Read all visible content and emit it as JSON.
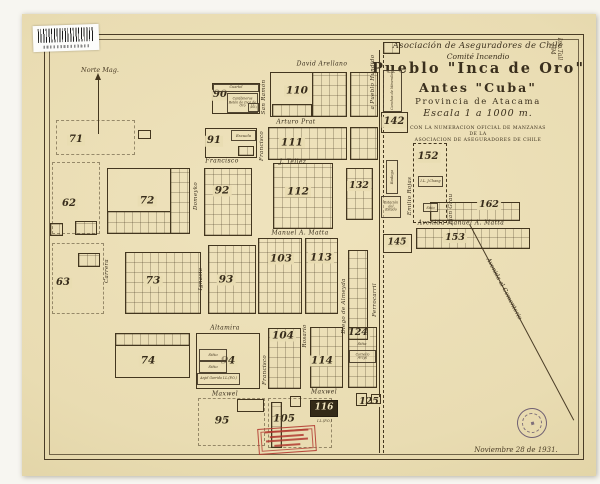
{
  "page": {
    "paper_color": "#e9dcb2",
    "ink_color": "#43361f",
    "stamp_red": "#b23a30",
    "stamp_purple": "#524264"
  },
  "title_block": {
    "org": "Asociación de Aseguradores de Chile",
    "committee": "Comité Incendio",
    "title1": "Pueblo \"Inca de Oro\"",
    "title2": "Antes \"Cuba\"",
    "province": "Provincia de Atacama",
    "scale": "Escala 1 a 1000 m.",
    "note1": "CON LA NUMERACION OFICIAL DE MANZANAS",
    "note2": "DE LA",
    "note3": "ASOCIACION DE ASEGURADORES DE CHILE"
  },
  "annotations": {
    "north": "Norte Mag.",
    "railroad_label": "Ferrocarril",
    "road_label": "a Pueblo Hundido",
    "cemetery_label": "Avenida al Cementerio",
    "date": "Noviembre 28 de 1931.",
    "corner_mark": "Inc.Tall\n194"
  },
  "map": {
    "streets_h": [
      {
        "name": "David Arellano",
        "x": 322,
        "y": 64
      },
      {
        "name": "Arturo Prat",
        "x": 296,
        "y": 122
      },
      {
        "name": "Francisco",
        "x": 222,
        "y": 161
      },
      {
        "name": "J. Tellez",
        "x": 293,
        "y": 162
      },
      {
        "name": "Manuel A. Matta",
        "x": 300,
        "y": 233
      },
      {
        "name": "Avenida Manuel A. Matta",
        "x": 461,
        "y": 223
      },
      {
        "name": "Altamira",
        "x": 225,
        "y": 328
      },
      {
        "name": "Maxwel",
        "x": 225,
        "y": 394
      },
      {
        "name": "Maxwel",
        "x": 324,
        "y": 392
      }
    ],
    "streets_v": [
      {
        "name": "San Ramón",
        "x": 264,
        "y": 97
      },
      {
        "name": "Francisco",
        "x": 262,
        "y": 146
      },
      {
        "name": "Domeyko",
        "x": 196,
        "y": 196
      },
      {
        "name": "Carrera",
        "x": 107,
        "y": 271
      },
      {
        "name": "Ignacio",
        "x": 201,
        "y": 279
      },
      {
        "name": "Francisco",
        "x": 265,
        "y": 370
      },
      {
        "name": "Rosario",
        "x": 305,
        "y": 336
      },
      {
        "name": "Diego de Almeyda",
        "x": 344,
        "y": 306
      },
      {
        "name": "Emilio Rojas",
        "x": 410,
        "y": 196
      },
      {
        "name": "Juan Grau",
        "x": 451,
        "y": 209
      }
    ],
    "blocks": [
      {
        "n": "62",
        "nx": 69,
        "ny": 204,
        "fs": 10
      },
      {
        "n": "63",
        "nx": 63,
        "ny": 283,
        "fs": 10
      },
      {
        "n": "71",
        "nx": 76,
        "ny": 140,
        "fs": 10
      },
      {
        "n": "72",
        "x": 107,
        "y": 168,
        "w": 83,
        "h": 66,
        "nx": 147,
        "ny": 201,
        "fs": 10.5
      },
      {
        "x": 170,
        "y": 168,
        "w": 20,
        "h": 66,
        "grid": true
      },
      {
        "x": 107,
        "y": 211,
        "w": 64,
        "h": 23,
        "grid": true
      },
      {
        "n": "73",
        "x": 125,
        "y": 252,
        "w": 76,
        "h": 62,
        "grid": true,
        "nx": 153,
        "ny": 281,
        "fs": 10.5
      },
      {
        "n": "74",
        "x": 115,
        "y": 333,
        "w": 75,
        "h": 45,
        "nx": 148,
        "ny": 361,
        "fs": 10.5
      },
      {
        "x": 115,
        "y": 333,
        "w": 75,
        "h": 13,
        "grid": true
      },
      {
        "n": "90",
        "x": 212,
        "y": 83,
        "w": 48,
        "h": 31,
        "nx": 220,
        "ny": 95,
        "fs": 10
      },
      {
        "n": "91",
        "x": 205,
        "y": 128,
        "w": 52,
        "h": 30,
        "nx": 214,
        "ny": 141,
        "fs": 10
      },
      {
        "n": "92",
        "x": 204,
        "y": 168,
        "w": 48,
        "h": 68,
        "grid": true,
        "nx": 222,
        "ny": 191,
        "fs": 10.5
      },
      {
        "n": "93",
        "x": 208,
        "y": 245,
        "w": 48,
        "h": 69,
        "grid": true,
        "nx": 226,
        "ny": 280,
        "fs": 10.5
      },
      {
        "n": "94",
        "x": 196,
        "y": 333,
        "w": 64,
        "h": 56,
        "nx": 228,
        "ny": 361,
        "fs": 10.5
      },
      {
        "n": "95",
        "nx": 222,
        "ny": 421,
        "fs": 10.5
      },
      {
        "x": 237,
        "y": 399,
        "w": 27,
        "h": 13
      },
      {
        "n": "103",
        "x": 258,
        "y": 238,
        "w": 44,
        "h": 76,
        "grid": true,
        "nx": 281,
        "ny": 259,
        "fs": 10.5
      },
      {
        "n": "104",
        "x": 268,
        "y": 328,
        "w": 33,
        "h": 61,
        "grid": true,
        "nx": 283,
        "ny": 336,
        "fs": 10.5
      },
      {
        "n": "105",
        "nx": 284,
        "ny": 419,
        "fs": 10.5
      },
      {
        "x": 271,
        "y": 402,
        "w": 11,
        "h": 46,
        "grid": true
      },
      {
        "x": 290,
        "y": 396,
        "w": 11,
        "h": 11
      },
      {
        "n": "110",
        "x": 270,
        "y": 72,
        "w": 77,
        "h": 45,
        "nx": 297,
        "ny": 91,
        "fs": 10.5
      },
      {
        "x": 312,
        "y": 72,
        "w": 35,
        "h": 45,
        "grid": true
      },
      {
        "x": 272,
        "y": 104,
        "w": 40,
        "h": 13,
        "grid": true
      },
      {
        "n": "111",
        "x": 268,
        "y": 127,
        "w": 79,
        "h": 33,
        "grid": true,
        "nx": 292,
        "ny": 143,
        "fs": 10.5
      },
      {
        "n": "112",
        "x": 273,
        "y": 163,
        "w": 60,
        "h": 66,
        "grid": true,
        "nx": 298,
        "ny": 192,
        "fs": 10.5
      },
      {
        "n": "113",
        "x": 305,
        "y": 238,
        "w": 33,
        "h": 76,
        "grid": true,
        "nx": 321,
        "ny": 258,
        "fs": 10.5
      },
      {
        "n": "114",
        "x": 310,
        "y": 327,
        "w": 33,
        "h": 61,
        "grid": true,
        "nx": 322,
        "ny": 361,
        "fs": 10.5
      },
      {
        "n": "116",
        "x": 310,
        "y": 400,
        "w": 28,
        "h": 17,
        "dark": true,
        "nx": 324,
        "ny": 408,
        "fs": 9
      },
      {
        "n": "124",
        "x": 348,
        "y": 327,
        "w": 29,
        "h": 61,
        "grid": true,
        "nx": 358,
        "ny": 333,
        "fs": 9.5
      },
      {
        "n": "125",
        "nx": 369,
        "ny": 402,
        "fs": 9.5
      },
      {
        "x": 356,
        "y": 393,
        "w": 11,
        "h": 13
      },
      {
        "x": 371,
        "y": 394,
        "w": 10,
        "h": 10
      },
      {
        "n": "132",
        "x": 346,
        "y": 168,
        "w": 27,
        "h": 52,
        "grid": true,
        "nx": 359,
        "ny": 186,
        "fs": 9.5
      },
      {
        "x": 350,
        "y": 72,
        "w": 28,
        "h": 45,
        "grid": true
      },
      {
        "x": 350,
        "y": 127,
        "w": 28,
        "h": 33,
        "grid": true
      },
      {
        "x": 348,
        "y": 250,
        "w": 20,
        "h": 90,
        "grid": true
      },
      {
        "n": "142",
        "x": 381,
        "y": 112,
        "w": 27,
        "h": 21,
        "nx": 394,
        "ny": 122,
        "fs": 10
      },
      {
        "n": "145",
        "x": 383,
        "y": 234,
        "w": 29,
        "h": 19,
        "nx": 397,
        "ny": 243,
        "fs": 9
      },
      {
        "n": "152",
        "x": 413,
        "y": 143,
        "w": 34,
        "h": 80,
        "dashed": true,
        "nx": 428,
        "ny": 157,
        "fs": 10
      },
      {
        "n": "153",
        "x": 416,
        "y": 228,
        "w": 114,
        "h": 21,
        "grid": true,
        "nx": 455,
        "ny": 238,
        "fs": 9.5
      },
      {
        "n": "162",
        "x": 430,
        "y": 202,
        "w": 90,
        "h": 19,
        "grid": true,
        "nx": 489,
        "ny": 205,
        "fs": 9.5
      },
      {
        "x": 383,
        "y": 42,
        "w": 17,
        "h": 12,
        "grid": true
      },
      {
        "x": 50,
        "y": 223,
        "w": 13,
        "h": 13,
        "grid": true
      },
      {
        "x": 75,
        "y": 221,
        "w": 22,
        "h": 14,
        "grid": true
      },
      {
        "x": 78,
        "y": 253,
        "w": 22,
        "h": 14,
        "grid": true
      },
      {
        "x": 138,
        "y": 130,
        "w": 13,
        "h": 9
      },
      {
        "x": 238,
        "y": 146,
        "w": 16,
        "h": 10,
        "grid": true
      }
    ],
    "dashed_areas": [
      {
        "x": 52,
        "y": 162,
        "w": 48,
        "h": 72
      },
      {
        "x": 52,
        "y": 243,
        "w": 52,
        "h": 71
      },
      {
        "x": 56,
        "y": 120,
        "w": 79,
        "h": 35
      },
      {
        "x": 198,
        "y": 398,
        "w": 67,
        "h": 48
      },
      {
        "x": 268,
        "y": 398,
        "w": 64,
        "h": 50
      }
    ],
    "labels": [
      {
        "label": "Cuartel",
        "x": 213,
        "y": 84,
        "w": 46,
        "h": 8,
        "box": true,
        "fs": 3.4
      },
      {
        "label": "Carabineros Retén de Inca de Oro",
        "x": 227,
        "y": 93,
        "w": 31,
        "h": 20,
        "box": true,
        "fs": 3.2
      },
      {
        "label": "I.L. (P.O.)",
        "x": 248,
        "y": 103,
        "w": 11,
        "h": 9,
        "box": true,
        "fs": 2.6
      },
      {
        "label": "Escuela",
        "x": 231,
        "y": 130,
        "w": 25,
        "h": 11,
        "box": true,
        "fs": 3.8
      },
      {
        "label": "I.L. J.Chang",
        "x": 418,
        "y": 176,
        "w": 25,
        "h": 11,
        "box": true,
        "fs": 3.4
      },
      {
        "label": "Sitio",
        "x": 423,
        "y": 203,
        "w": 15,
        "h": 9,
        "box": true,
        "fs": 3.6
      },
      {
        "label": "Sitio",
        "x": 199,
        "y": 349,
        "w": 28,
        "h": 12,
        "box": true,
        "fs": 4
      },
      {
        "label": "Sitio",
        "x": 199,
        "y": 361,
        "w": 28,
        "h": 12,
        "box": true,
        "fs": 4
      },
      {
        "label": "Anjel Garrido I.L.(P.O.)",
        "x": 197,
        "y": 373,
        "w": 43,
        "h": 12,
        "box": true,
        "fs": 3.2
      },
      {
        "label": "Sitio",
        "x": 350,
        "y": 339,
        "w": 24,
        "h": 10,
        "box": false,
        "fs": 3.8
      },
      {
        "label": "Cornelio Araya",
        "x": 349,
        "y": 350,
        "w": 27,
        "h": 13,
        "box": true,
        "fs": 3.2
      },
      {
        "label": "I.L.(P.O.)",
        "x": 311,
        "y": 418,
        "w": 27,
        "h": 8,
        "box": false,
        "fs": 3.4
      },
      {
        "label": "Canchas de Minerales",
        "x": 383,
        "y": 70,
        "w": 19,
        "h": 42,
        "box": true,
        "rot": true,
        "fs": 3.4
      },
      {
        "label": "Bodega",
        "x": 386,
        "y": 160,
        "w": 12,
        "h": 34,
        "box": true,
        "rot": true,
        "fs": 3.8
      },
      {
        "label": "Estación del Estado",
        "x": 381,
        "y": 196,
        "w": 20,
        "h": 22,
        "box": true,
        "fs": 3.3
      }
    ]
  }
}
